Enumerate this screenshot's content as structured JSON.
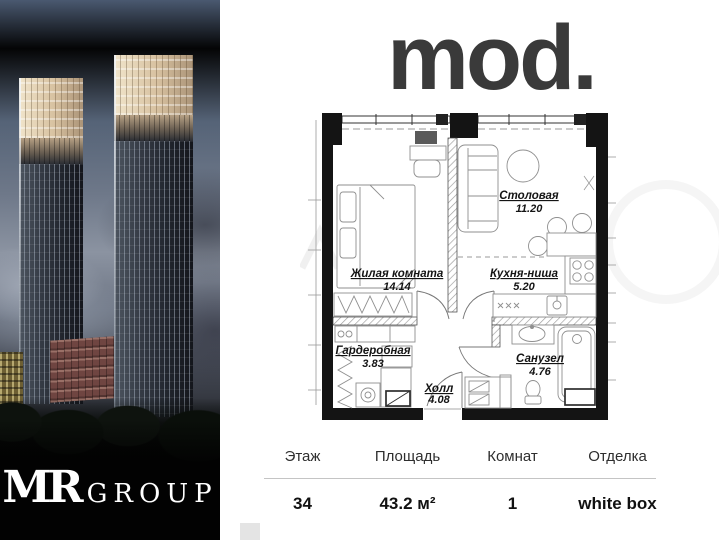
{
  "window": {
    "width": 719,
    "height": 540,
    "background": "#ffffff"
  },
  "left_panel": {
    "type": "building-render-photo",
    "developer_logo": {
      "mark": "MR",
      "text": "GROUP"
    },
    "colors": {
      "sky_top": "#4a5970",
      "sky_clouds": "#8b93a1",
      "tower_crown": "#d7c1a0",
      "tower_body": "#20242c",
      "mid_building": "#6f4541",
      "ground": "#020202"
    }
  },
  "brand": {
    "logo_text": "mod.",
    "color": "#3a3a3a"
  },
  "floor_plan": {
    "wall_color": "#141414",
    "rooms": [
      {
        "id": "living",
        "name": "Жилая комната",
        "area": "14.14"
      },
      {
        "id": "dining",
        "name": "Столовая",
        "area": "11.20"
      },
      {
        "id": "kitchen",
        "name": "Кухня-ниша",
        "area": "5.20"
      },
      {
        "id": "wardrobe",
        "name": "Гардеробная",
        "area": "3.83"
      },
      {
        "id": "hall",
        "name": "Холл",
        "area": "4.08"
      },
      {
        "id": "bathroom",
        "name": "Санузел",
        "area": "4.76"
      }
    ]
  },
  "details_table": {
    "columns": [
      {
        "label": "Этаж",
        "value": "34"
      },
      {
        "label": "Площадь",
        "value": "43.2 м²"
      },
      {
        "label": "Комнат",
        "value": "1"
      },
      {
        "label": "Отделка",
        "value": "white box"
      }
    ]
  }
}
